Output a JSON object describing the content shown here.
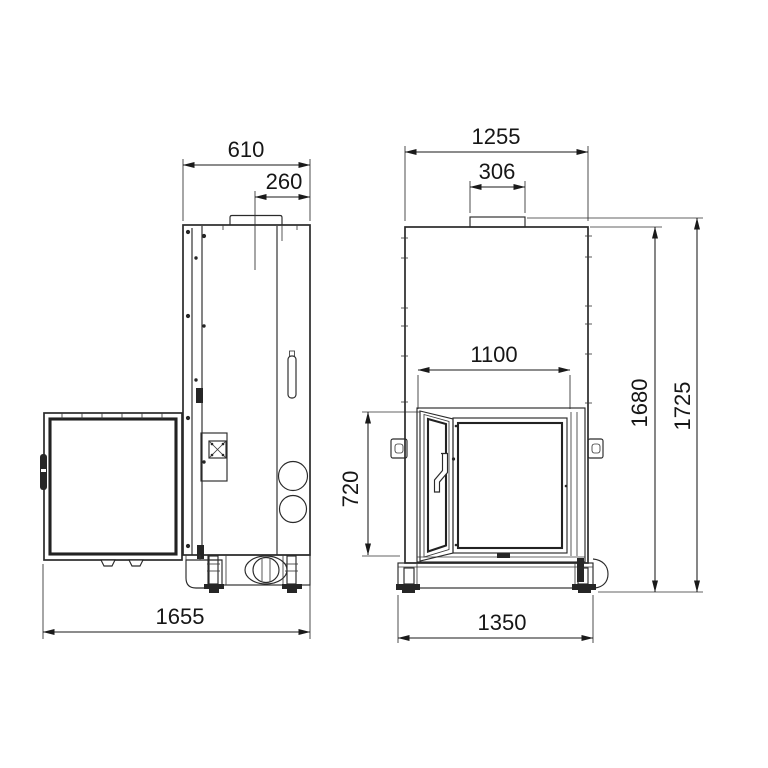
{
  "drawing": {
    "title": "fireplace-insert-dimension-drawing",
    "colors": {
      "background": "#ffffff",
      "line": "#2a2a2a",
      "dimension": "#1a1a1a"
    },
    "side_view": {
      "width_top": "610",
      "flue_offset": "260",
      "depth_total": "1655"
    },
    "front_view": {
      "width_top": "1255",
      "flue_width": "306",
      "opening_width": "1100",
      "opening_height": "720",
      "height_body": "1680",
      "height_total": "1725",
      "base_width": "1350"
    }
  }
}
